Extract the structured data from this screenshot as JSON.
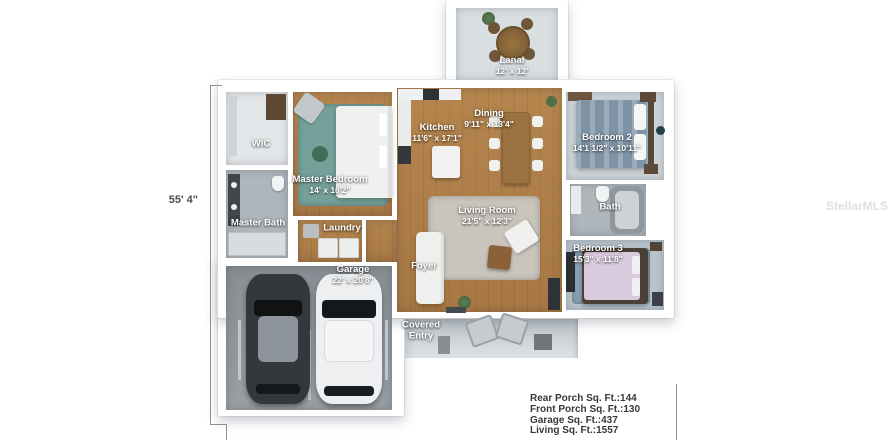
{
  "watermark": "StellarMLS",
  "palette": {
    "bg": "#ffffff",
    "wall": "#ffffff",
    "wood": "#b5854e",
    "wood-dark": "#a87843",
    "carpet": "#ced5da",
    "carpet-b3": "#bac5cd",
    "tile": "#aeb6bc",
    "garage-floor": "#99a0a5",
    "slab": "#d9dee1",
    "rug-teal": "#75a09a",
    "rug-gray": "#c9c4bc",
    "rug-blue": "#8ba0b2",
    "label": "#ffffff",
    "dim-text": "#4b4f54",
    "stats-text": "#34383d",
    "line": "#8d9296"
  },
  "rooms": {
    "lanai": {
      "name": "Lanai",
      "dims": "12' x 12'"
    },
    "kitchen": {
      "name": "Kitchen",
      "dims": "11'6\" x 17'1\""
    },
    "dining": {
      "name": "Dining",
      "dims": "9'11\" x 13'4\""
    },
    "bedroom2": {
      "name": "Bedroom 2",
      "dims": "14'1 1/2\" x 10'11\""
    },
    "wic": {
      "name": "WIC"
    },
    "master_bedroom": {
      "name": "Master Bedroom",
      "dims": "14' x 16'2\""
    },
    "master_bath": {
      "name": "Master Bath"
    },
    "laundry": {
      "name": "Laundry"
    },
    "living_room": {
      "name": "Living Room",
      "dims": "21'5\" x 12'3\""
    },
    "bath": {
      "name": "Bath"
    },
    "bedroom3": {
      "name": "Bedroom 3",
      "dims": "15'3\" x 11'8\""
    },
    "garage": {
      "name": "Garage",
      "dims": "22' x 20'8\""
    },
    "foyer": {
      "name": "Foyer"
    },
    "covered_entry": {
      "line1": "Covered",
      "line2": "Entry"
    }
  },
  "dimensions": {
    "left_height": "55' 4\""
  },
  "stats": {
    "lines": [
      "Rear Porch Sq. Ft.:144",
      "Front Porch Sq. Ft.:130",
      "Garage Sq. Ft.:437",
      "Living Sq. Ft.:1557"
    ]
  }
}
